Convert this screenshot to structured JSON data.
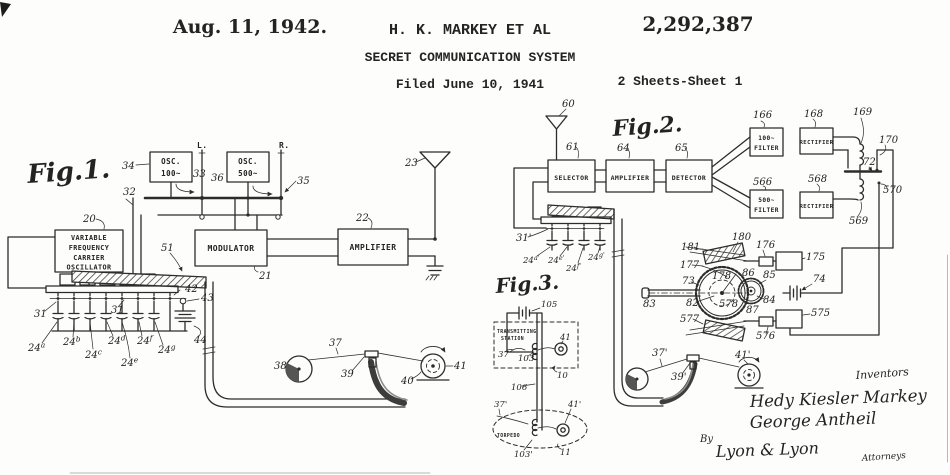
{
  "header": {
    "date": "Aug. 11, 1942.",
    "author": "H. K. MARKEY ET AL",
    "patent_number": "2,292,387",
    "title": "SECRET COMMUNICATION SYSTEM",
    "filed": "Filed June 10, 1941",
    "sheet": "2 Sheets-Sheet 1"
  },
  "fig1": {
    "title": "Fig.1.",
    "osc100_line1": "OSC.",
    "osc100_line2": "100~",
    "osc500_line1": "OSC.",
    "osc500_line2": "500~",
    "vfco_line1": "VARIABLE",
    "vfco_line2": "FREQUENCY",
    "vfco_line3": "CARRIER",
    "vfco_line4": "OSCILLATOR",
    "modulator": "MODULATOR",
    "amplifier": "AMPLIFIER",
    "terminal_left": "L.",
    "terminal_right": "R.",
    "refs": {
      "n20": "20",
      "n21": "21",
      "n22": "22",
      "n23": "23",
      "n31a": "31",
      "n31b": "31",
      "n32": "32",
      "n33": "33",
      "n34": "34",
      "n35": "35",
      "n36": "36",
      "n37": "37",
      "n38": "38",
      "n39": "39",
      "n40": "40",
      "n41": "41",
      "n42": "42",
      "n43": "43",
      "n44": "44",
      "n51": "51"
    },
    "caps": {
      "n24a": {
        "base": "24",
        "sup": "a"
      },
      "n24b": {
        "base": "24",
        "sup": "b"
      },
      "n24c": {
        "base": "24",
        "sup": "c"
      },
      "n24d": {
        "base": "24",
        "sup": "d"
      },
      "n24e": {
        "base": "24",
        "sup": "e"
      },
      "n24f": {
        "base": "24",
        "sup": "f"
      },
      "n24g": {
        "base": "24",
        "sup": "g"
      }
    }
  },
  "fig2": {
    "title": "Fig.2.",
    "selector": "SELECTOR",
    "amplifier": "AMPLIFIER",
    "detector": "DETECTOR",
    "filter100_line1": "100~",
    "filter100_line2": "FILTER",
    "rectifier_top": "RECTIFIER",
    "filter500_line1": "500~",
    "filter500_line2": "FILTER",
    "rectifier_bottom": "RECTIFIER",
    "refs": {
      "n60": "60",
      "n61": "61",
      "n64": "64",
      "n65": "65",
      "n166": "166",
      "n168": "168",
      "n169": "169",
      "n170": "170",
      "n72": "72",
      "n566": "566",
      "n568": "568",
      "n569": "569",
      "n570": "570",
      "n180": "180",
      "n181": "181",
      "n176": "176",
      "n175": "175",
      "n177": "177",
      "n73": "73",
      "n82": "82",
      "n83": "83",
      "n178": "178",
      "n578": "578",
      "n86": "86",
      "n85": "85",
      "n84": "84",
      "n87": "87",
      "n577": "577",
      "n575": "575",
      "n576": "576",
      "n74": "74",
      "n31p": "31'",
      "n37p": "37'",
      "n39p": "39'",
      "n41p": "41'"
    },
    "caps": {
      "n24ap": {
        "base": "24",
        "sup": "a'"
      },
      "n24ep": {
        "base": "24",
        "sup": "e'"
      },
      "n24fp": {
        "base": "24",
        "sup": "f'"
      },
      "n24gp": {
        "base": "24",
        "sup": "g'"
      }
    }
  },
  "fig3": {
    "title": "Fig.3.",
    "station_line1": "TRANSMITTING",
    "station_line2": "STATION",
    "torpedo": "TORPEDO",
    "refs": {
      "n105": "105",
      "n10": "10",
      "n106": "106",
      "n11": "11",
      "n37": "37",
      "n41": "41",
      "n103": "103",
      "n37p": "37'",
      "n41p": "41'",
      "n103p": "103'"
    }
  },
  "signature": {
    "inventors_caption": "Inventors",
    "inventor1": "Hedy Kiesler Markey",
    "inventor2": "George Antheil",
    "by_label": "By",
    "firm": "Lyon & Lyon",
    "attorneys_caption": "Attorneys"
  }
}
